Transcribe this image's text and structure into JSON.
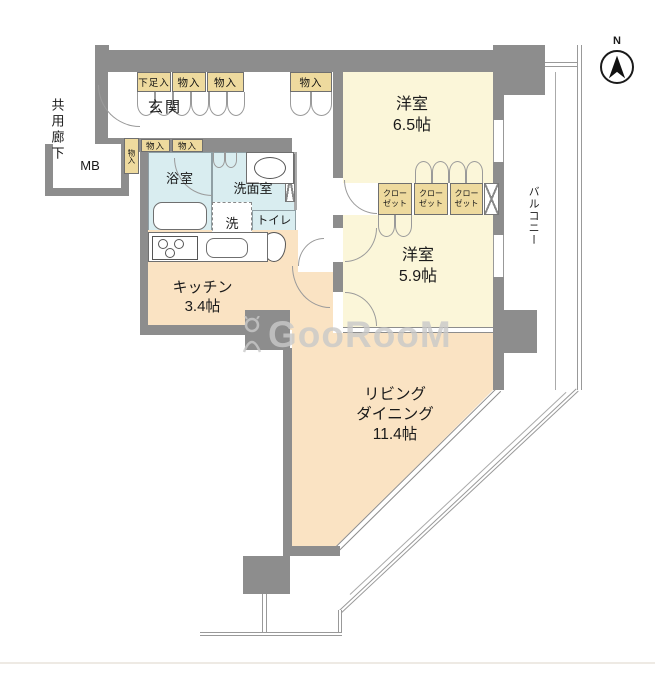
{
  "title": "apartment-floor-plan",
  "colors": {
    "wall": "#8d8d8d",
    "room_cream": "#fbf6d9",
    "room_peach": "#fae3c3",
    "room_blue": "#d9edf0",
    "storage_tan": "#eeda9e",
    "watermark_gray": "#c9c9c9"
  },
  "compass": {
    "north_label": "N"
  },
  "watermark": {
    "text": "GooRooM"
  },
  "rooms": {
    "common_corridor": {
      "label": "共用廊下"
    },
    "meter_box": {
      "label": "MB"
    },
    "entrance": {
      "label": "玄関"
    },
    "shoe_storage": {
      "label": "下足入"
    },
    "storage": {
      "label": "物入"
    },
    "bathroom": {
      "label": "浴室"
    },
    "washroom": {
      "label": "洗面室"
    },
    "laundry": {
      "label": "洗"
    },
    "toilet": {
      "label": "トイレ"
    },
    "kitchen": {
      "name": "キッチン",
      "size": "3.4帖"
    },
    "bedroom_65": {
      "name": "洋室",
      "size": "6.5帖"
    },
    "bedroom_59": {
      "name": "洋室",
      "size": "5.9帖"
    },
    "living": {
      "line1": "リビング",
      "line2": "ダイニング",
      "line3": "11.4帖"
    },
    "closet": {
      "line1": "クロー",
      "line2": "ゼット"
    },
    "balcony": {
      "label": "バルコニー"
    }
  }
}
